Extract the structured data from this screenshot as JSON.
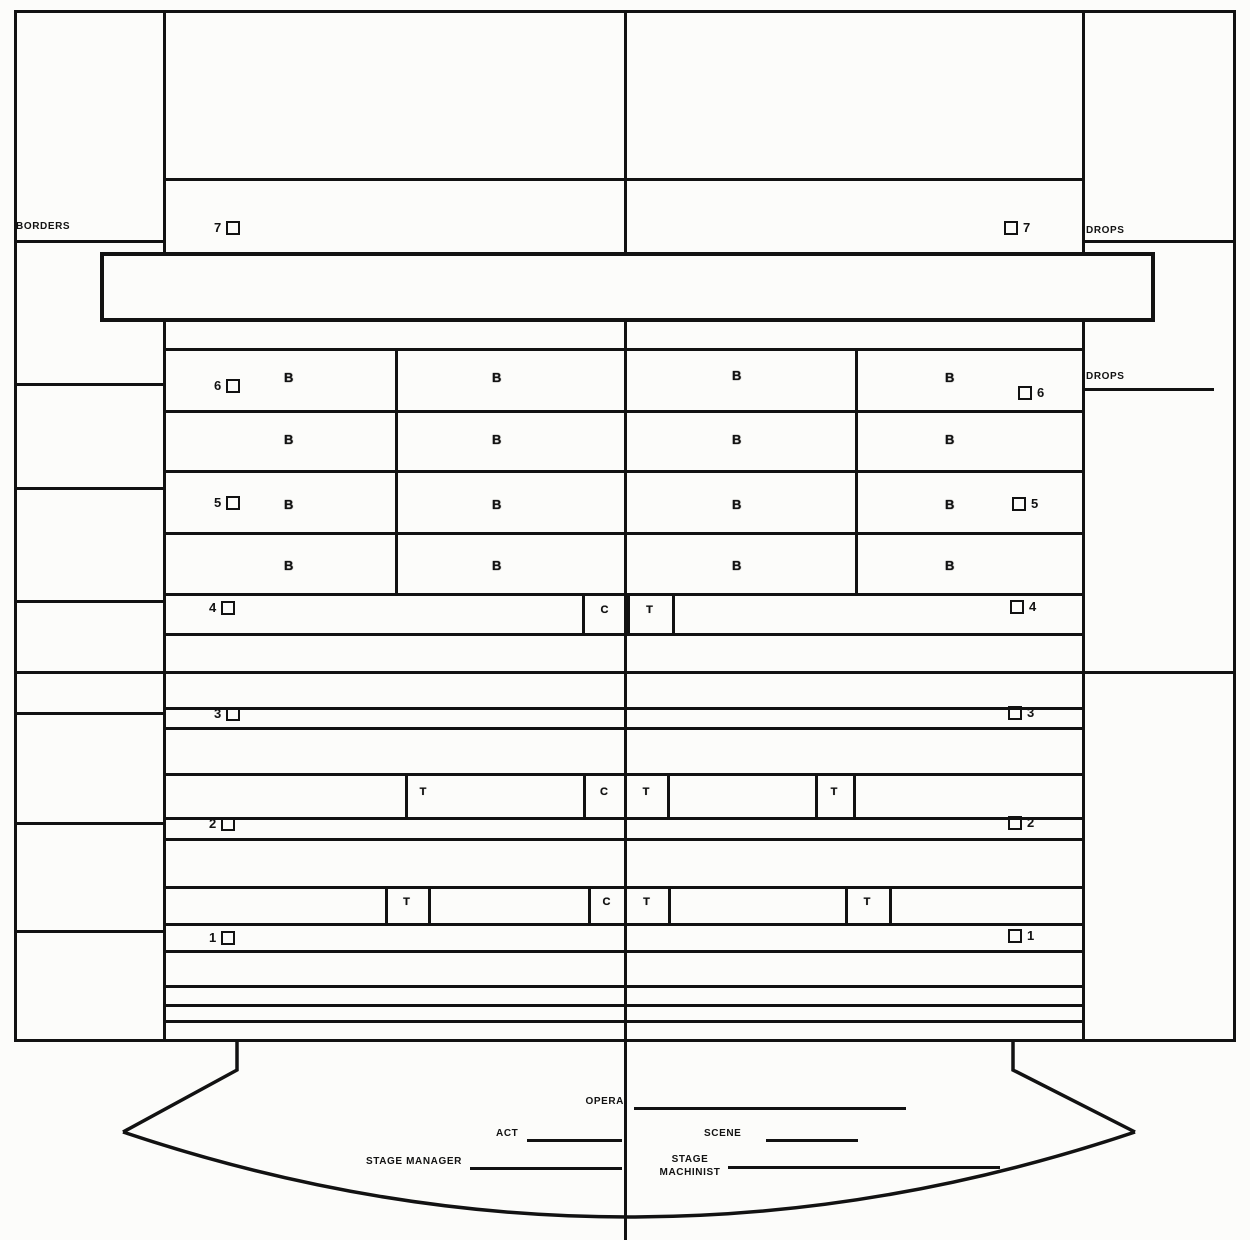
{
  "diagram_title": "stage-rigging-plan",
  "columns": {
    "left_label": "BORDERS",
    "right_label_top": "DROPS",
    "right_label_mid": "DROPS"
  },
  "battens": {
    "left_numbers": [
      "7",
      "6",
      "5",
      "4",
      "3",
      "2",
      "1"
    ],
    "right_numbers": [
      "7",
      "6",
      "5",
      "4",
      "3",
      "2",
      "1"
    ]
  },
  "markers": {
    "border_light": "B",
    "center_line": "C",
    "tormentor": "T"
  },
  "footer": {
    "opera_label": "OPERA",
    "act_label": "ACT",
    "scene_label": "SCENE",
    "stage_manager_label": "STAGE MANAGER",
    "stage_machinist_line1": "STAGE",
    "stage_machinist_line2": "MACHINIST"
  },
  "colors": {
    "ink": "#121212",
    "paper": "#fcfcfa"
  }
}
